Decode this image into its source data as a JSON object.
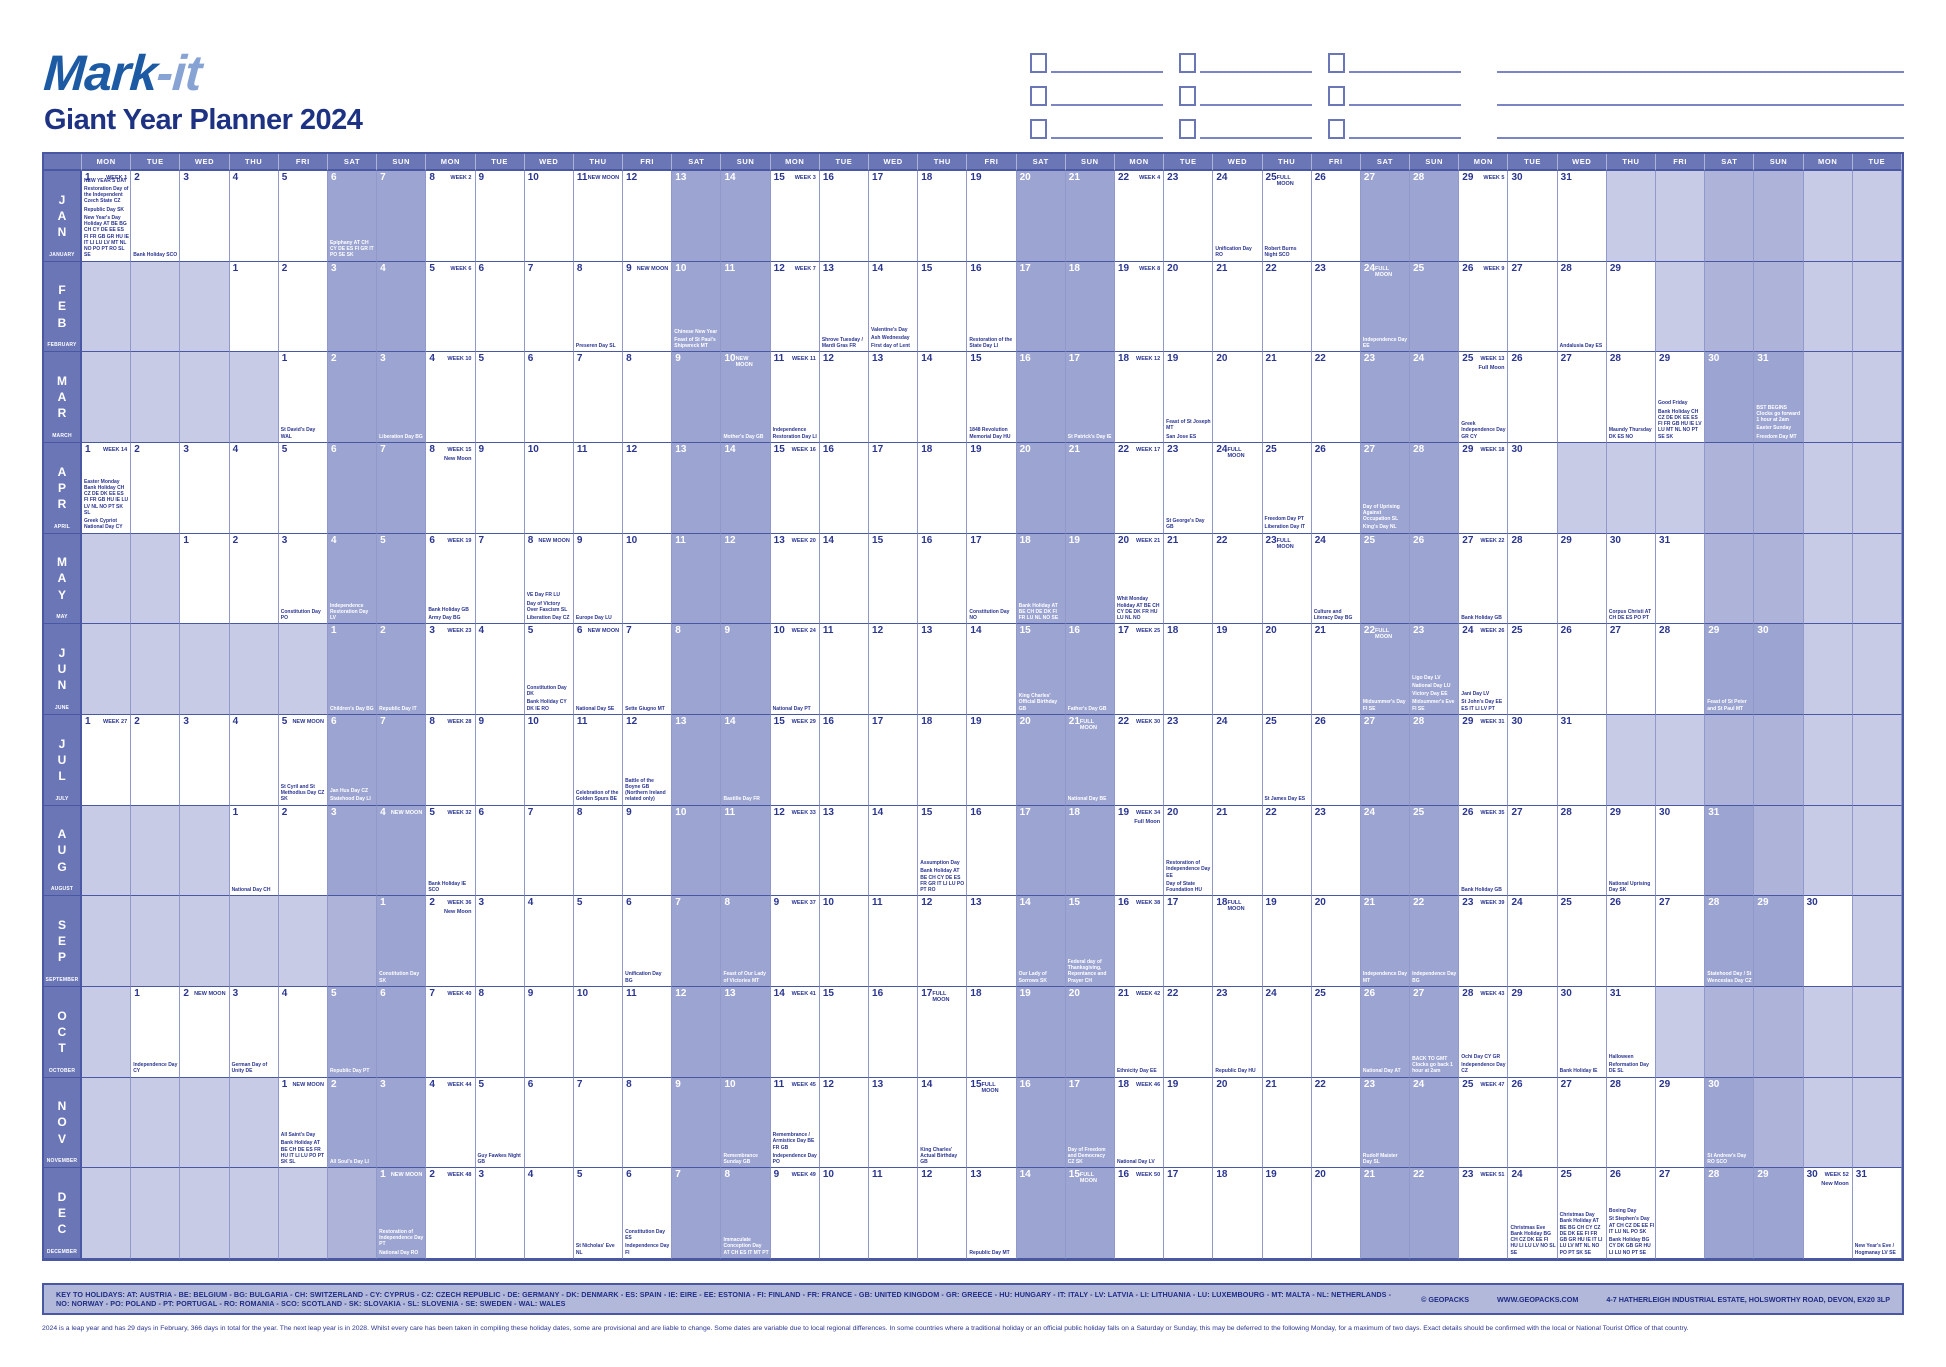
{
  "header": {
    "logo_part1": "Mark",
    "logo_part2": "-it",
    "title": "Giant Year Planner 2024",
    "note_rows": 3,
    "note_groups_per_row": 3
  },
  "calendar": {
    "columns": 37,
    "day_names": [
      "MON",
      "TUE",
      "WED",
      "THU",
      "FRI",
      "SAT",
      "SUN"
    ],
    "months": [
      {
        "abbr": "JAN",
        "name": "JANUARY",
        "start_col": 0,
        "days": 31,
        "weeks": {
          "1": "WEEK 1",
          "8": "WEEK 2",
          "15": "WEEK 3",
          "22": "WEEK 4",
          "29": "WEEK 5"
        },
        "moons": {
          "11": "New Moon",
          "25": "Full Moon"
        },
        "holidays": {
          "1": [
            "NEW YEAR'S DAY",
            "Restoration Day of the Independent Czech State CZ",
            "Republic Day SK",
            "New Year's Day Holiday AT BE BG CH CY DE EE ES FI FR GB GR HU IE IT LI LU LV MT NL NO PO PT RO SL SE"
          ],
          "2": [
            "Bank Holiday SCO"
          ],
          "6": [
            "Epiphany AT CH CY DE ES FI GR IT PO SE SK"
          ],
          "24": [
            "Unification Day RO"
          ],
          "25": [
            "Robert Burns Night SCO"
          ]
        }
      },
      {
        "abbr": "FEB",
        "name": "FEBRUARY",
        "start_col": 3,
        "days": 29,
        "weeks": {
          "5": "WEEK 6",
          "12": "WEEK 7",
          "19": "WEEK 8",
          "26": "WEEK 9"
        },
        "moons": {
          "9": "New Moon",
          "24": "Full Moon"
        },
        "holidays": {
          "8": [
            "Preseren Day SL"
          ],
          "10": [
            "Chinese New Year",
            "Feast of St Paul's Shipwreck MT"
          ],
          "13": [
            "Shrove Tuesday / Mardi Gras FR"
          ],
          "14": [
            "Valentine's Day",
            "Ash Wednesday",
            "First day of Lent"
          ],
          "16": [
            "Restoration of the State Day LI"
          ],
          "24": [
            "Independence Day EE"
          ],
          "28": [
            "Andalusia Day ES"
          ]
        }
      },
      {
        "abbr": "MAR",
        "name": "MARCH",
        "start_col": 4,
        "days": 31,
        "weeks": {
          "4": "WEEK 10",
          "11": "WEEK 11",
          "18": "WEEK 12",
          "25": "WEEK 13"
        },
        "moons": {
          "10": "New Moon",
          "25": "Full Moon"
        },
        "holidays": {
          "1": [
            "St David's Day WAL"
          ],
          "3": [
            "Liberation Day BG"
          ],
          "10": [
            "Mother's Day GB"
          ],
          "11": [
            "Independence Restoration Day LI"
          ],
          "15": [
            "1848 Revolution Memorial Day HU"
          ],
          "17": [
            "St Patrick's Day IE"
          ],
          "19": [
            "Feast of St Joseph MT",
            "San Jose ES"
          ],
          "25": [
            "Greek Independence Day GR CY"
          ],
          "28": [
            "Maundy Thursday DK ES NO"
          ],
          "29": [
            "Good Friday",
            "Bank Holiday CH CZ DE DK EE ES FI FR GB HU IE LV LU MT NL NO PT SE SK"
          ],
          "31": [
            "BST BEGINS Clocks go forward 1 hour at 2am",
            "Easter Sunday",
            "Freedom Day MT"
          ]
        }
      },
      {
        "abbr": "APR",
        "name": "APRIL",
        "start_col": 0,
        "days": 30,
        "weeks": {
          "1": "WEEK 14",
          "8": "WEEK 15",
          "15": "WEEK 16",
          "22": "WEEK 17",
          "29": "WEEK 18"
        },
        "moons": {
          "8": "New Moon",
          "24": "Full Moon"
        },
        "holidays": {
          "1": [
            "Easter Monday Bank Holiday CH CZ DE DK EE ES FI FR GB HU IE LU LV NL NO PT SK SL",
            "Greek Cypriot National Day CY"
          ],
          "23": [
            "St George's Day GB"
          ],
          "25": [
            "Freedom Day PT",
            "Liberation Day IT"
          ],
          "27": [
            "Day of Uprising Against Occupation SL",
            "King's Day NL"
          ]
        }
      },
      {
        "abbr": "MAY",
        "name": "MAY",
        "start_col": 2,
        "days": 31,
        "weeks": {
          "6": "WEEK 19",
          "13": "WEEK 20",
          "20": "WEEK 21",
          "27": "WEEK 22"
        },
        "moons": {
          "8": "New Moon",
          "23": "Full Moon"
        },
        "holidays": {
          "3": [
            "Constitution Day PO"
          ],
          "4": [
            "Independence Restoration Day LV"
          ],
          "6": [
            "Bank Holiday GB",
            "Army Day BG"
          ],
          "8": [
            "VE Day FR LU",
            "Day of Victory Over Fascism SL",
            "Liberation Day CZ"
          ],
          "9": [
            "Europe Day LU"
          ],
          "17": [
            "Constitution Day NO"
          ],
          "18": [
            "Bank Holiday AT BE CH DE DK FI FR LU NL NO SE"
          ],
          "20": [
            "Whit Monday Holiday AT BE CH CY DE DK FR HU LU NL NO"
          ],
          "24": [
            "Culture and Literacy Day BG"
          ],
          "27": [
            "Bank Holiday GB"
          ],
          "30": [
            "Corpus Christi AT CH DE ES PO PT"
          ]
        }
      },
      {
        "abbr": "JUN",
        "name": "JUNE",
        "start_col": 5,
        "days": 30,
        "weeks": {
          "3": "WEEK 23",
          "10": "WEEK 24",
          "17": "WEEK 25",
          "24": "WEEK 26"
        },
        "moons": {
          "6": "New Moon",
          "22": "Full Moon"
        },
        "holidays": {
          "1": [
            "Children's Day BG"
          ],
          "2": [
            "Republic Day IT"
          ],
          "5": [
            "Constitution Day DK",
            "Bank Holiday CY DK IE RO"
          ],
          "6": [
            "National Day SE"
          ],
          "7": [
            "Sette Giugno MT"
          ],
          "10": [
            "National Day PT"
          ],
          "15": [
            "King Charles' Official Birthday GB"
          ],
          "16": [
            "Father's Day GB"
          ],
          "22": [
            "Midsummer's Day FI SE"
          ],
          "23": [
            "Ligo Day LV",
            "National Day LU",
            "Victory Day EE",
            "Midsummer's Eve FI SE"
          ],
          "24": [
            "Jani Day LV",
            "St John's Day EE ES IT LI LV PT"
          ],
          "29": [
            "Feast of St Peter and St Paul MT"
          ]
        }
      },
      {
        "abbr": "JUL",
        "name": "JULY",
        "start_col": 0,
        "days": 31,
        "weeks": {
          "1": "WEEK 27",
          "8": "WEEK 28",
          "15": "WEEK 29",
          "22": "WEEK 30",
          "29": "WEEK 31"
        },
        "moons": {
          "5": "New Moon",
          "21": "Full Moon"
        },
        "holidays": {
          "5": [
            "St Cyril and St Methodius Day CZ SK"
          ],
          "6": [
            "Jan Hus Day CZ",
            "Statehood Day LI"
          ],
          "11": [
            "Celebration of the Golden Spurs BE"
          ],
          "12": [
            "Battle of the Boyne GB (Northern Ireland related only)"
          ],
          "14": [
            "Bastille Day FR"
          ],
          "21": [
            "National Day BE"
          ],
          "25": [
            "St James Day ES"
          ]
        }
      },
      {
        "abbr": "AUG",
        "name": "AUGUST",
        "start_col": 3,
        "days": 31,
        "weeks": {
          "5": "WEEK 32",
          "12": "WEEK 33",
          "19": "WEEK 34",
          "26": "WEEK 35"
        },
        "moons": {
          "4": "New Moon",
          "19": "Full Moon"
        },
        "holidays": {
          "1": [
            "National Day CH"
          ],
          "5": [
            "Bank Holiday IE SCO"
          ],
          "15": [
            "Assumption Day",
            "Bank Holiday AT BE CH CY DE ES FR GR IT LI LU PO PT RO"
          ],
          "20": [
            "Restoration of Independence Day EE",
            "Day of State Foundation HU"
          ],
          "26": [
            "Bank Holiday GB"
          ],
          "29": [
            "National Uprising Day SK"
          ]
        }
      },
      {
        "abbr": "SEP",
        "name": "SEPTEMBER",
        "start_col": 6,
        "days": 30,
        "weeks": {
          "2": "WEEK 36",
          "9": "WEEK 37",
          "16": "WEEK 38",
          "23": "WEEK 39"
        },
        "moons": {
          "2": "New Moon",
          "18": "Full Moon"
        },
        "holidays": {
          "1": [
            "Constitution Day SK"
          ],
          "6": [
            "Unification Day BG"
          ],
          "8": [
            "Feast of Our Lady of Victories MT"
          ],
          "14": [
            "Our Lady of Sorrows SK"
          ],
          "15": [
            "Federal day of Thanksgiving, Repentance and Prayer CH"
          ],
          "21": [
            "Independence Day MT"
          ],
          "22": [
            "Independence Day BG"
          ],
          "28": [
            "Statehood Day / St Wenceslas Day CZ"
          ]
        }
      },
      {
        "abbr": "OCT",
        "name": "OCTOBER",
        "start_col": 1,
        "days": 31,
        "weeks": {
          "7": "WEEK 40",
          "14": "WEEK 41",
          "21": "WEEK 42",
          "28": "WEEK 43"
        },
        "moons": {
          "2": "New Moon",
          "17": "Full Moon"
        },
        "holidays": {
          "1": [
            "Independence Day CY"
          ],
          "3": [
            "German Day of Unity DE"
          ],
          "5": [
            "Republic Day PT"
          ],
          "21": [
            "Ethnicity Day EE"
          ],
          "23": [
            "Republic Day HU"
          ],
          "26": [
            "National Day AT"
          ],
          "27": [
            "BACK TO GMT Clocks go back 1 hour at 2am"
          ],
          "28": [
            "Ochi Day CY GR",
            "Independence Day CZ"
          ],
          "30": [
            "Bank Holiday IE"
          ],
          "31": [
            "Halloween",
            "Reformation Day DE SL"
          ]
        }
      },
      {
        "abbr": "NOV",
        "name": "NOVEMBER",
        "start_col": 4,
        "days": 30,
        "weeks": {
          "4": "WEEK 44",
          "11": "WEEK 45",
          "18": "WEEK 46",
          "25": "WEEK 47"
        },
        "moons": {
          "1": "New Moon",
          "15": "Full Moon"
        },
        "holidays": {
          "1": [
            "All Saint's Day",
            "Bank Holiday AT BE CH DE ES FR HU IT LI LU PO PT SK SL"
          ],
          "2": [
            "All Soul's Day LI"
          ],
          "5": [
            "Guy Fawkes Night GB"
          ],
          "10": [
            "Remembrance Sunday GB"
          ],
          "11": [
            "Remembrance / Armistice Day BE FR GB",
            "Independence Day PO"
          ],
          "14": [
            "King Charles' Actual Birthday GB"
          ],
          "17": [
            "Day of Freedom and Democracy CZ SK"
          ],
          "18": [
            "National Day LV"
          ],
          "23": [
            "Rudolf Maister Day SL"
          ],
          "30": [
            "St Andrew's Day RO SCO"
          ]
        }
      },
      {
        "abbr": "DEC",
        "name": "DECEMBER",
        "start_col": 6,
        "days": 31,
        "weeks": {
          "2": "WEEK 48",
          "9": "WEEK 49",
          "16": "WEEK 50",
          "23": "WEEK 51",
          "30": "WEEK 52"
        },
        "moons": {
          "1": "New Moon",
          "15": "Full Moon",
          "30": "New Moon"
        },
        "holidays": {
          "1": [
            "Restoration of Independence Day PT",
            "National Day RO"
          ],
          "5": [
            "St Nicholas' Eve NL"
          ],
          "6": [
            "Constitution Day ES",
            "Independence Day FI"
          ],
          "8": [
            "Immaculate Conception Day AT CH ES IT MT PT"
          ],
          "13": [
            "Republic Day MT"
          ],
          "24": [
            "Christmas Eve Bank Holiday BG CH CZ DK EE FI HU LI LU LV NO SL SE"
          ],
          "25": [
            "Christmas Day Bank Holiday AT BE BG CH CY CZ DE DK EE FI FR GB GR HU IE IT LI LU LV MT NL NO PO PT SK SE"
          ],
          "26": [
            "Boxing Day",
            "St Stephen's Day AT CH CZ DE EE FI IT LU NL PO SK",
            "Bank Holiday BG CY DK GB GR HU LI LU NO PT SE"
          ],
          "31": [
            "New Year's Eve / Hogmanay LV SE"
          ]
        }
      }
    ]
  },
  "footer": {
    "key_line": "KEY TO HOLIDAYS: AT: AUSTRIA - BE: BELGIUM - BG: BULGARIA - CH: SWITZERLAND - CY: CYPRUS - CZ: CZECH REPUBLIC - DE: GERMANY - DK: DENMARK - ES: SPAIN - IE: EIRE - EE: ESTONIA - FI: FINLAND - FR: FRANCE - GB: UNITED KINGDOM - GR: GREECE - HU: HUNGARY - IT: ITALY - LV: LATVIA - LI: LITHUANIA - LU: LUXEMBOURG - MT: MALTA - NL: NETHERLANDS - NO: NORWAY - PO: POLAND - PT: PORTUGAL - RO: ROMANIA - SCO: SCOTLAND - SK: SLOVAKIA - SL: SLOVENIA - SE: SWEDEN - WAL: WALES",
    "copyright": "© GEOPACKS",
    "website": "WWW.GEOPACKS.COM",
    "address": "4-7 HATHERLEIGH INDUSTRIAL ESTATE, HOLSWORTHY ROAD, DEVON, EX20 3LP",
    "disclaimer": "2024 is a leap year and has 29 days in February, 366 days in total for the year. The next leap year is in 2028. Whilst every care has been taken in compiling these holiday dates, some are provisional and are liable to change. Some dates are variable due to local regional differences. In some countries where a traditional holiday or an official public holiday falls on a Saturday or Sunday, this may be deferred to the following Monday, for a maximum of two days. Exact details should be confirmed with the local or National Tourist Office of that country."
  },
  "colors": {
    "header_bg": "#6b76b7",
    "weekend_bg": "#9ca4d1",
    "out_of_month_bg": "#c7cbe5",
    "ink": "#2a3590",
    "logo_dark": "#1d5aa4",
    "logo_light": "#86a3d4",
    "title": "#1e3283",
    "key_bar_bg": "#b2b8d9"
  }
}
